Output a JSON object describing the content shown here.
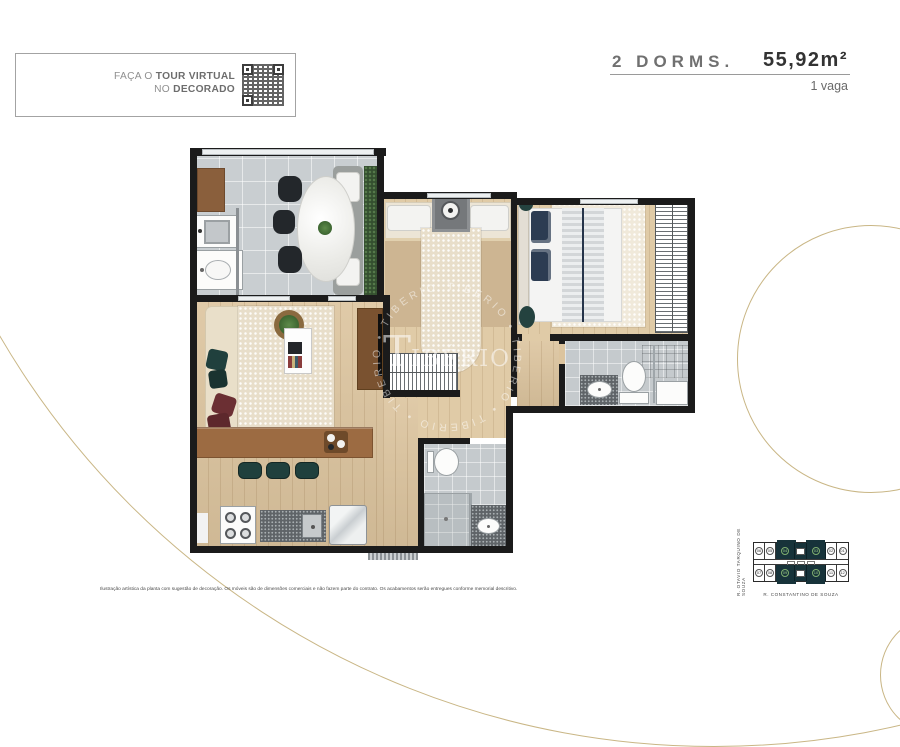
{
  "page": {
    "bg": "#ffffff",
    "accent_gold": "#c9b685"
  },
  "tour_box": {
    "line1_normal": "FAÇA O ",
    "line1_bold": "TOUR VIRTUAL",
    "line2_normal": "NO ",
    "line2_bold": "DECORADO"
  },
  "header": {
    "unit_type": "2 DORMS.",
    "area": "55,92m²",
    "parking": "1 vaga"
  },
  "watermark": {
    "ring_text": "TIBERIO • TIBERIO • TIBERIO • TIBERIO • TIBERIO • ",
    "logo_t": "T",
    "logo_rest": "IBÉRIO"
  },
  "disclaimer": {
    "text": "Ilustração artística da planta com sugestão de decoração. Os móveis são de dimensões comerciais e não fazem parte do contrato. Os acabamentos serão entregues conforme memorial descritivo."
  },
  "keyplan": {
    "street_left": "R. OTAVIO TARQUINO DE SOUZA",
    "street_bottom": "R. CONSTANTINO DE SOUZA",
    "units_top": [
      "06",
      "05",
      "04",
      "03",
      "02",
      "01"
    ],
    "units_bottom": [
      "07",
      "08",
      "09",
      "10",
      "11",
      "12"
    ],
    "highlight_color": "#17333a"
  },
  "colors": {
    "wall": "#1b1b1b",
    "wood": "#dcc49e",
    "tile": "#c9ced1",
    "teal_furniture": "#20403d",
    "maroon_cushion": "#6b2f33",
    "hedge_green": "#344f2f"
  }
}
